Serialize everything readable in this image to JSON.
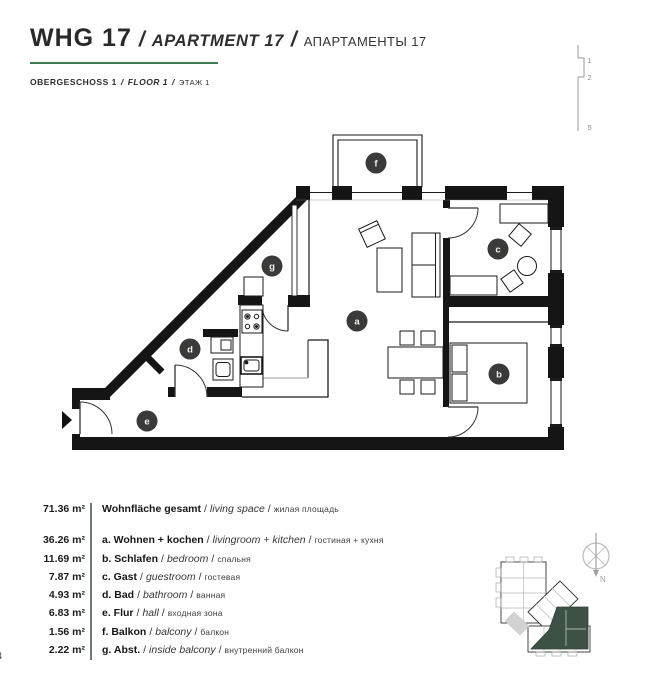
{
  "header": {
    "accent_color": "#3f7a52",
    "title": {
      "de": "WHG 17",
      "sep": "/",
      "en": "APARTMENT 17",
      "ru": "АПАРТАМЕНТЫ 17"
    },
    "subtitle": {
      "de": "OBERGESCHOSS 1",
      "sep": "/",
      "en": "FLOOR 1",
      "ru": "ЭТАЖ 1"
    }
  },
  "level_indicator": {
    "marks": [
      "1",
      "2",
      "5"
    ]
  },
  "plan": {
    "badge_color": "#3a3a3a",
    "keyplan_highlight_color": "#3d5245",
    "compass_label": "N",
    "rooms": [
      {
        "id": "a",
        "label": "a",
        "name": "living-kitchen"
      },
      {
        "id": "b",
        "label": "b",
        "name": "bedroom"
      },
      {
        "id": "c",
        "label": "c",
        "name": "guestroom"
      },
      {
        "id": "d",
        "label": "d",
        "name": "bathroom"
      },
      {
        "id": "e",
        "label": "e",
        "name": "hall"
      },
      {
        "id": "f",
        "label": "f",
        "name": "balcony"
      },
      {
        "id": "g",
        "label": "g",
        "name": "inside-balcony"
      }
    ]
  },
  "area_table": {
    "separator": "/",
    "divider_color": "#6e7b76",
    "total": {
      "value": "71.36 m²",
      "de": "Wohnfläche gesamt",
      "en": "living space",
      "ru": "жилая площадь"
    },
    "rows": [
      {
        "value": "36.26 m²",
        "de": "a. Wohnen + kochen",
        "en": "livingroom + kitchen",
        "ru": "гостиная + кухня"
      },
      {
        "value": "11.69 m²",
        "de": "b. Schlafen",
        "en": "bedroom",
        "ru": "спальня"
      },
      {
        "value": "7.87 m²",
        "de": "c. Gast",
        "en": "guestroom",
        "ru": "гостевая"
      },
      {
        "value": "4.93 m²",
        "de": "d. Bad",
        "en": "bathroom",
        "ru": "ванная"
      },
      {
        "value": "6.83 m²",
        "de": "e. Flur",
        "en": "hall",
        "ru": "входная зона"
      },
      {
        "value": "1.56 m²",
        "de": "f. Balkon",
        "en": "balcony",
        "ru": "балкон"
      },
      {
        "value": "2.22 m²",
        "de": "g. Abst.",
        "en": "inside balcony",
        "ru": "внутренний балкон"
      }
    ]
  },
  "footer": {
    "page": "4"
  }
}
